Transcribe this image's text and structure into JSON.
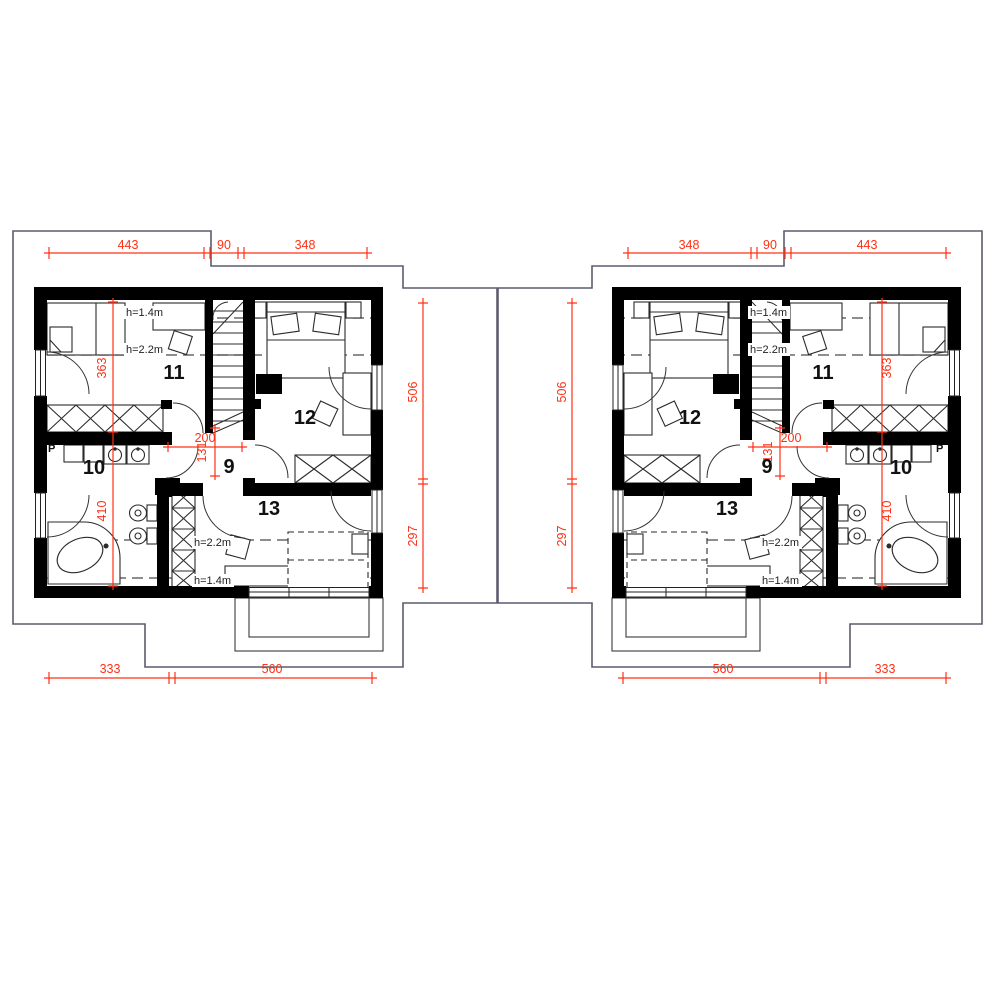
{
  "title": "Attic floor plan - mirrored duplex units",
  "colors": {
    "dimension_red": "#ff3014",
    "wall_black": "#000000",
    "roof_outline_gray": "#5c5c6e",
    "furniture_gray": "#2b2b2b"
  },
  "left": {
    "top_dims": {
      "d1": "443",
      "d2": "90",
      "d3": "348"
    },
    "side_dims": {
      "upper": "506",
      "lower": "297"
    },
    "inner_dims": {
      "v_upper": "363",
      "v_lower": "410",
      "w": "200",
      "h": "131"
    },
    "rooms": {
      "r9": "9",
      "r10": "10",
      "r11": "11",
      "r12": "12",
      "r13": "13"
    },
    "heights": {
      "h14": "h=1.4m",
      "h22": "h=2.2m"
    },
    "washer": "P",
    "bottom_dims": {
      "d1": "333",
      "d2": "560"
    }
  },
  "right": {
    "top_dims": {
      "d1": "348",
      "d2": "90",
      "d3": "443"
    },
    "side_dims": {
      "upper": "506",
      "lower": "297"
    },
    "inner_dims": {
      "v_upper": "363",
      "v_lower": "410",
      "w": "200",
      "h": "131"
    },
    "rooms": {
      "r9": "9",
      "r10": "10",
      "r11": "11",
      "r12": "12",
      "r13": "13"
    },
    "heights": {
      "h14": "h=1.4m",
      "h22": "h=2.2m"
    },
    "washer": "P",
    "bottom_dims": {
      "d1": "560",
      "d2": "333"
    }
  }
}
